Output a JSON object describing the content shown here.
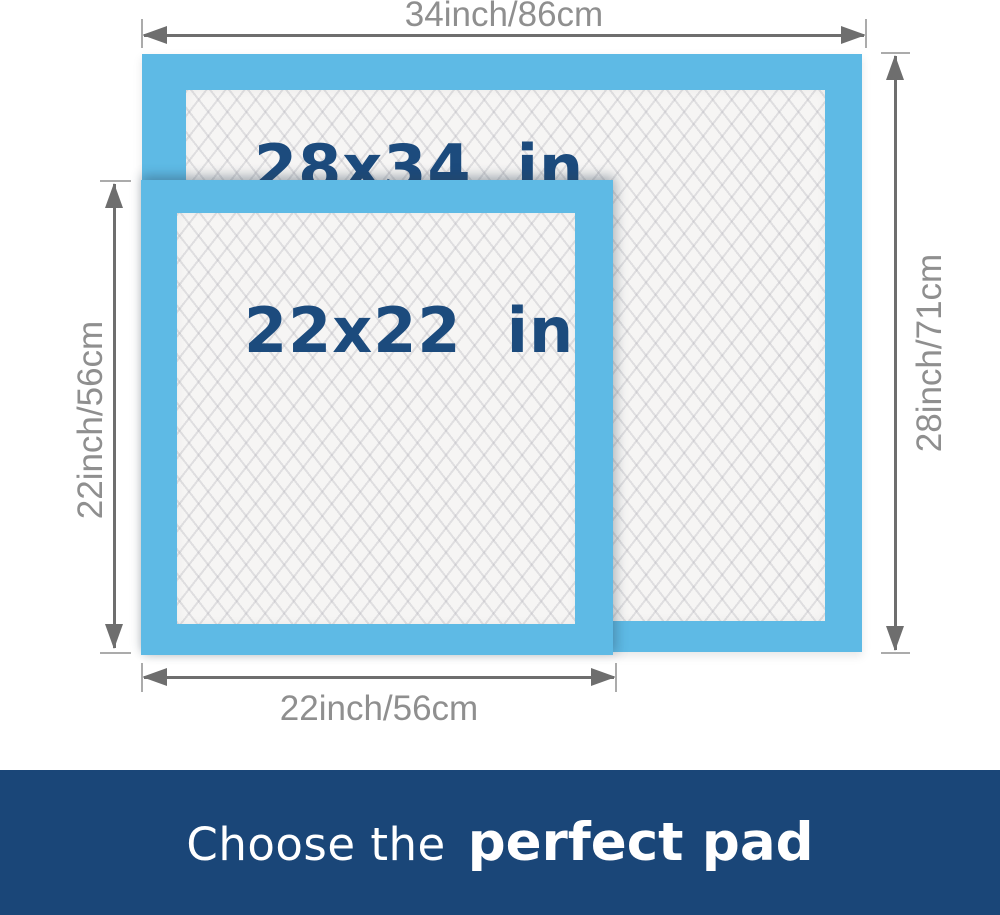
{
  "diagram": {
    "large_pad": {
      "size_label": "28x34  in",
      "width_dimension": "34inch/86cm",
      "height_dimension": "28inch/71cm"
    },
    "small_pad": {
      "size_label": "22x22  in",
      "height_dimension": "22inch/56cm",
      "width_dimension": "22inch/56cm"
    }
  },
  "banner": {
    "prefix": "Choose the",
    "highlight": "perfect pad"
  },
  "colors": {
    "pad_blue": "#5EBAE5",
    "label_navy": "#1C4B7D",
    "banner_navy": "#1A4678",
    "dim_text": "#8F8F8F",
    "dim_line": "#6E6E6E",
    "quilt_bg": "#F6F5F4"
  }
}
